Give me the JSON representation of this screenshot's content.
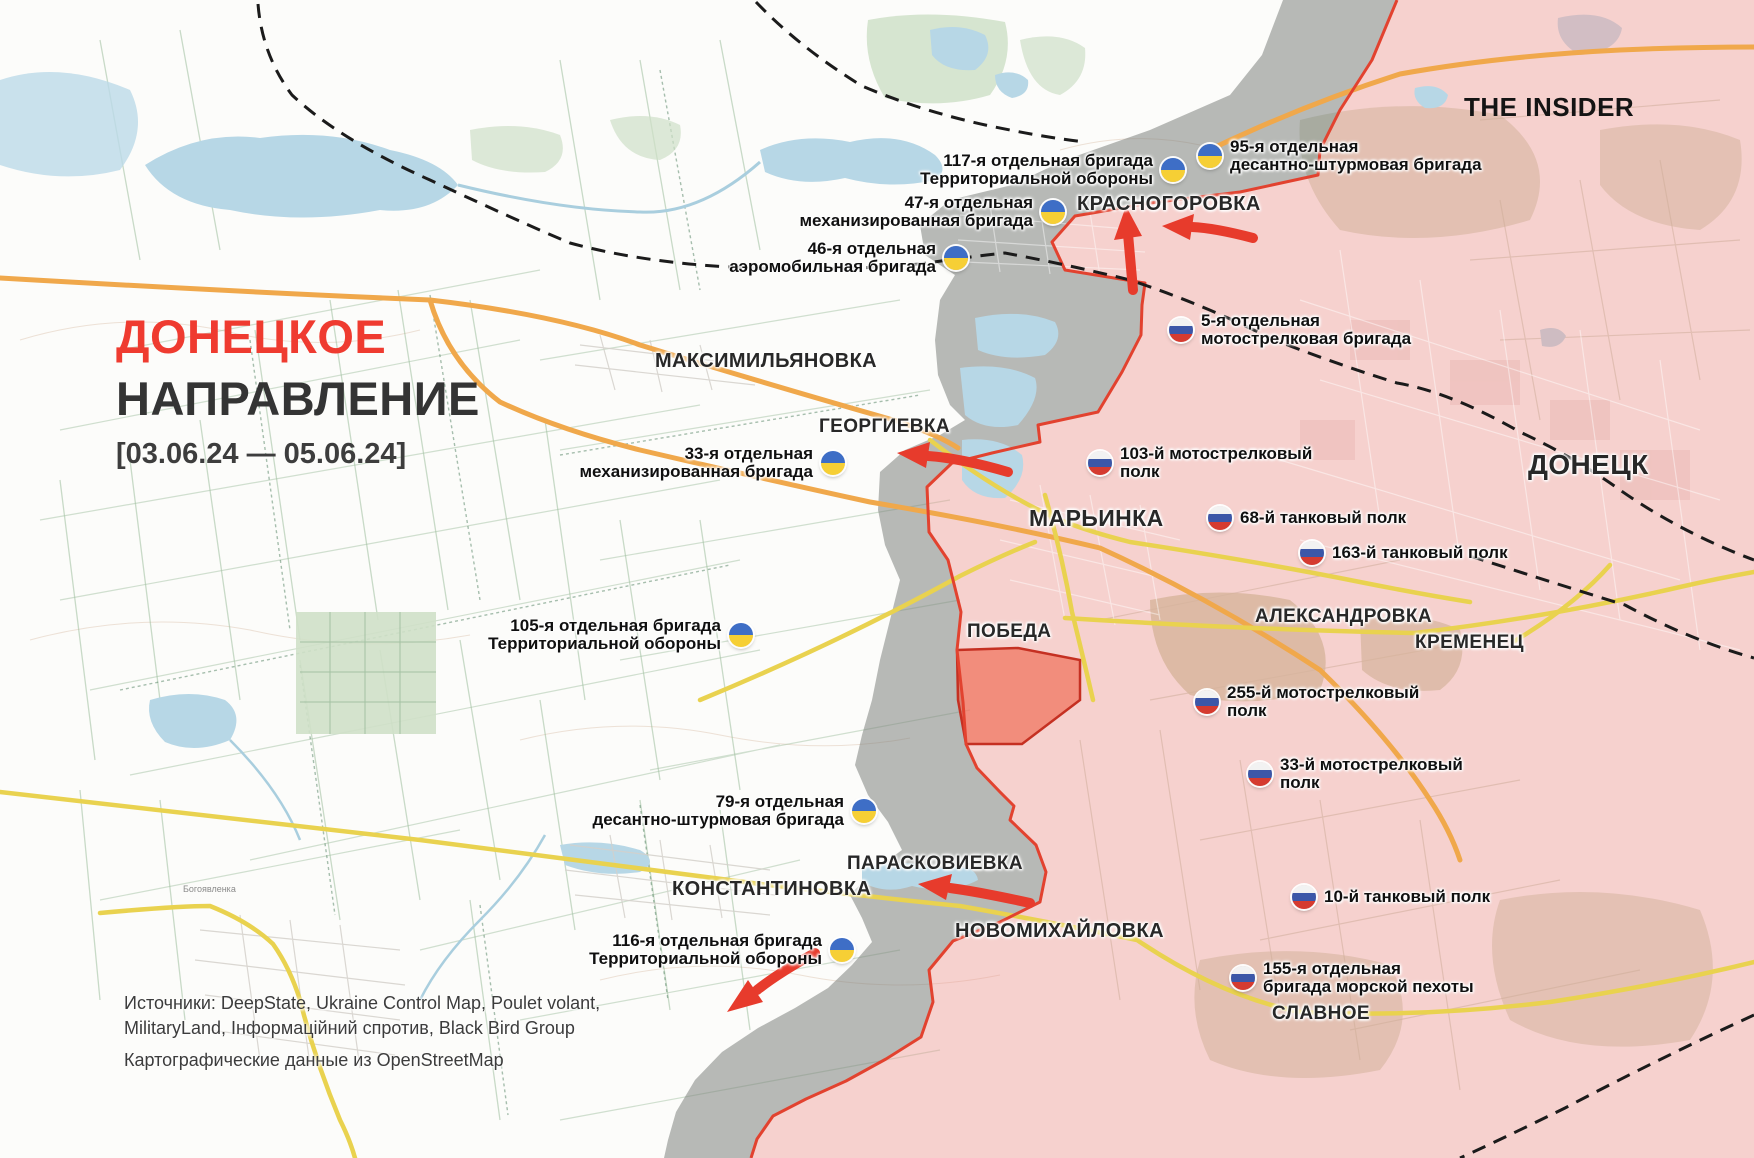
{
  "branding": {
    "logo": "THE INSIDER"
  },
  "title": {
    "line1": "ДОНЕЦКОЕ",
    "line2": "НАПРАВЛЕНИЕ",
    "date_range": "[03.06.24 — 05.06.24]"
  },
  "sources": {
    "line1": "Источники: DeepState, Ukraine Control Map, Poulet volant,",
    "line2": "MilitaryLand, Інформаційний спротив, Black Bird Group",
    "line3": "Картографические данные из OpenStreetMap"
  },
  "cities": [
    {
      "id": "krasnohorivka",
      "name": "КРАСНОГОРОВКА",
      "x": 1077,
      "y": 193,
      "size": 20
    },
    {
      "id": "maksymilianivka",
      "name": "МАКСИМИЛЬЯНОВКА",
      "x": 655,
      "y": 350,
      "size": 20
    },
    {
      "id": "heorhiivka",
      "name": "ГЕОРГИЕВКА",
      "x": 819,
      "y": 416,
      "size": 19
    },
    {
      "id": "donetsk",
      "name": "ДОНЕЦК",
      "x": 1528,
      "y": 449,
      "size": 28
    },
    {
      "id": "marinka",
      "name": "МАРЬИНКА",
      "x": 1029,
      "y": 505,
      "size": 23
    },
    {
      "id": "oleksandrivka",
      "name": "АЛЕКСАНДРОВКА",
      "x": 1255,
      "y": 606,
      "size": 19
    },
    {
      "id": "kremenets",
      "name": "КРЕМЕНЕЦ",
      "x": 1415,
      "y": 632,
      "size": 19
    },
    {
      "id": "pobieda",
      "name": "ПОБЕДА",
      "x": 967,
      "y": 621,
      "size": 19
    },
    {
      "id": "paraskoviivka",
      "name": "ПАРАСКОВИЕВКА",
      "x": 847,
      "y": 853,
      "size": 19
    },
    {
      "id": "kostiantynivka",
      "name": "КОНСТАНТИНОВКА",
      "x": 672,
      "y": 878,
      "size": 20
    },
    {
      "id": "novomykhailivka",
      "name": "НОВОМИХАЙЛОВКА",
      "x": 955,
      "y": 920,
      "size": 20
    },
    {
      "id": "slavne",
      "name": "СЛАВНОЕ",
      "x": 1272,
      "y": 1003,
      "size": 19
    }
  ],
  "units": {
    "ukraine": [
      {
        "id": "117-tro",
        "lines": [
          "117-я отдельная бригада",
          "Территориальной обороны"
        ],
        "flag_x": 1173,
        "flag_y": 170,
        "text_side": "left"
      },
      {
        "id": "95-dshb",
        "lines": [
          "95-я отдельная",
          "десантно-штурмовая бригада"
        ],
        "flag_x": 1210,
        "flag_y": 156,
        "text_side": "right"
      },
      {
        "id": "47-ombr",
        "lines": [
          "47-я отдельная",
          "механизированная бригада"
        ],
        "flag_x": 1053,
        "flag_y": 212,
        "text_side": "left"
      },
      {
        "id": "46-aemb",
        "lines": [
          "46-я отдельная",
          "аэромобильная бригада"
        ],
        "flag_x": 956,
        "flag_y": 258,
        "text_side": "left"
      },
      {
        "id": "33-ombr",
        "lines": [
          "33-я отдельная",
          "механизированная бригада"
        ],
        "flag_x": 833,
        "flag_y": 463,
        "text_side": "left"
      },
      {
        "id": "105-tro",
        "lines": [
          "105-я отдельная бригада",
          "Территориальной обороны"
        ],
        "flag_x": 741,
        "flag_y": 635,
        "text_side": "left"
      },
      {
        "id": "79-dshb",
        "lines": [
          "79-я отдельная",
          "десантно-штурмовая бригада"
        ],
        "flag_x": 864,
        "flag_y": 811,
        "text_side": "left"
      },
      {
        "id": "116-tro",
        "lines": [
          "116-я отдельная бригада",
          "Территориальной обороны"
        ],
        "flag_x": 842,
        "flag_y": 950,
        "text_side": "left"
      }
    ],
    "russia": [
      {
        "id": "5-omsbr",
        "lines": [
          "5-я отдельная",
          "мотострелковая бригада"
        ],
        "flag_x": 1181,
        "flag_y": 330,
        "text_side": "right"
      },
      {
        "id": "103-msp",
        "lines": [
          "103-й мотострелковый",
          "полк"
        ],
        "flag_x": 1100,
        "flag_y": 463,
        "text_side": "right"
      },
      {
        "id": "68-tp",
        "lines": [
          "68-й танковый полк"
        ],
        "flag_x": 1220,
        "flag_y": 518,
        "text_side": "right"
      },
      {
        "id": "163-tp",
        "lines": [
          "163-й танковый полк"
        ],
        "flag_x": 1312,
        "flag_y": 553,
        "text_side": "right"
      },
      {
        "id": "255-msp",
        "lines": [
          "255-й мотострелковый",
          "полк"
        ],
        "flag_x": 1207,
        "flag_y": 702,
        "text_side": "right"
      },
      {
        "id": "33-msp",
        "lines": [
          "33-й мотострелковый",
          "полк"
        ],
        "flag_x": 1260,
        "flag_y": 774,
        "text_side": "right"
      },
      {
        "id": "10-tp",
        "lines": [
          "10-й танковый полк"
        ],
        "flag_x": 1304,
        "flag_y": 897,
        "text_side": "right"
      },
      {
        "id": "155-mp",
        "lines": [
          "155-я отдельная",
          "бригада морской пехоты"
        ],
        "flag_x": 1243,
        "flag_y": 978,
        "text_side": "right"
      }
    ]
  },
  "map_labels": [
    {
      "text": "Богоявленка",
      "x": 183,
      "y": 884,
      "size": 9
    }
  ],
  "colors": {
    "accent_red": "#ef3b30",
    "front_line": "#e2422f",
    "occupied_fill": "rgba(238,150,146,0.42)",
    "contested_fill": "rgba(125,130,126,0.55)",
    "advance_fill": "rgba(240,95,70,0.6)",
    "arrow_red": "#e73b2c"
  },
  "flags": {
    "ua": [
      "#3e6ec6",
      "#f6cf35"
    ],
    "ru": [
      "#f2f2f2",
      "#3c57a8",
      "#d53b30"
    ]
  }
}
